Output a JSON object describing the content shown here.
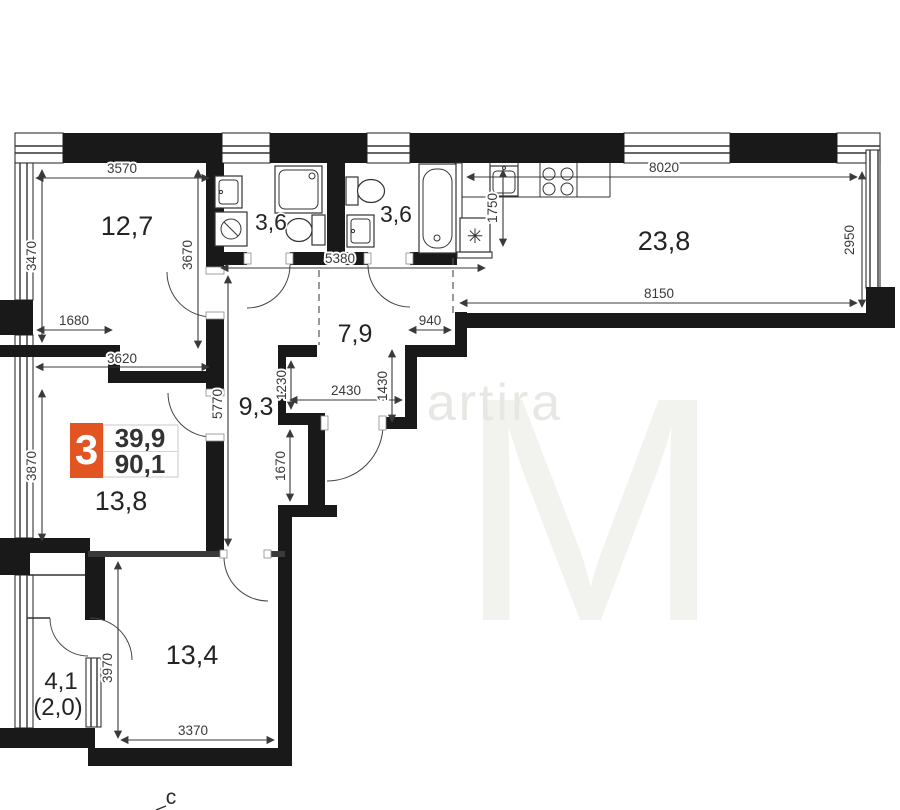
{
  "watermark": {
    "text": "artira",
    "big_letter": "M"
  },
  "north": {
    "label": "с"
  },
  "badge": {
    "rooms_count": "3",
    "value_top": "39,9",
    "value_bottom": "90,1",
    "accent_color": "#e25422"
  },
  "rooms": {
    "room1": {
      "name": "room-12-7",
      "area": "12,7"
    },
    "bath1": {
      "name": "bathroom-1",
      "area": "3,6"
    },
    "bath2": {
      "name": "bathroom-2",
      "area": "3,6"
    },
    "kitchen": {
      "name": "kitchen-living",
      "area": "23,8"
    },
    "hall": {
      "name": "hall",
      "area": "7,9"
    },
    "corridor": {
      "name": "corridor",
      "area": "9,3"
    },
    "room2": {
      "name": "room-13-8",
      "area": "13,8"
    },
    "room3": {
      "name": "room-13-4",
      "area": "13,4"
    },
    "balcony": {
      "name": "balcony",
      "area": "4,1",
      "area_secondary": "(2,0)"
    }
  },
  "dims": {
    "d3570": "3570",
    "d3470": "3470",
    "d3670": "3670",
    "d1680": "1680",
    "d3620": "3620",
    "d3870": "3870",
    "d5770": "5770",
    "d5380": "5380",
    "d1230": "1230",
    "d2430": "2430",
    "d1430": "1430",
    "d940": "940",
    "d1670": "1670",
    "d1750": "1750",
    "d8020": "8020",
    "d2950": "2950",
    "d8150": "8150",
    "d3970": "3970",
    "d3370": "3370"
  },
  "symbols": {
    "shaft": "✳"
  }
}
